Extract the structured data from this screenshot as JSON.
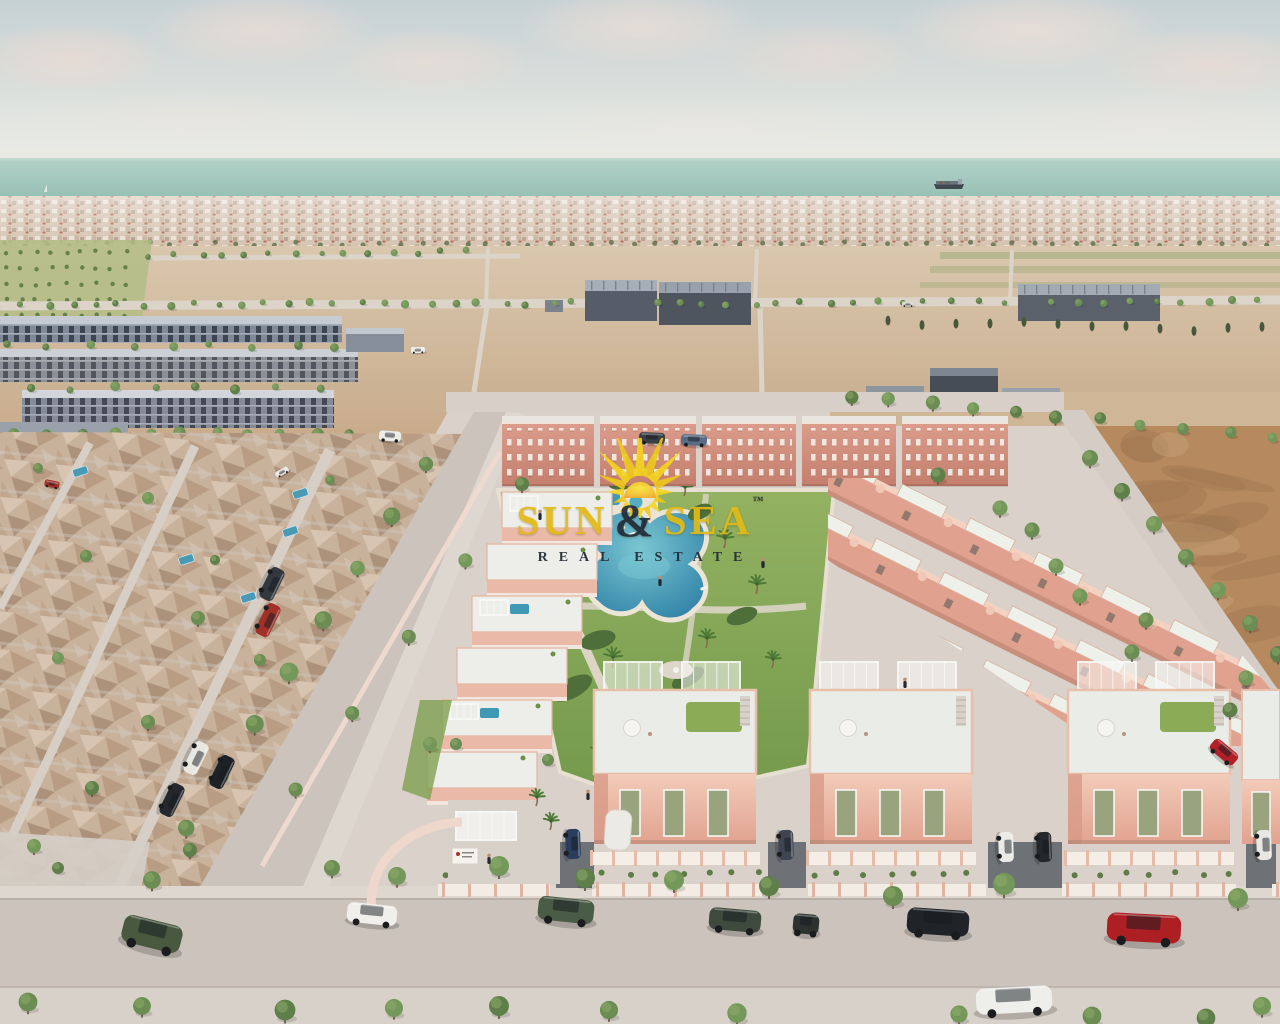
{
  "image": {
    "type": "aerial-3d-architectural-render",
    "subject": "New-build residential development of pink townhouses around a communal lagoon pool, beside an existing neighborhood, vacant plots and the sea on the horizon"
  },
  "watermark": {
    "word1": "SUN",
    "ampersand": "&",
    "word2": "SEA",
    "trademark": "™",
    "subtitle": "REAL ESTATE",
    "colors": {
      "gold": "#E2BA16",
      "dark": "#232B36",
      "sun_yellow": "#F5D51D",
      "sun_orange": "#F0A22E"
    }
  },
  "palette": {
    "sky_top": "#C6D1D4",
    "sky_horizon": "#ECECE6",
    "sea": "#9FC6BC",
    "sand": "#D3BFA6",
    "dirt": "#B68A5E",
    "road": "#DCD4C9",
    "street": "#CCC4BC",
    "sidewalk": "#DED7CF",
    "villa_pink": "#E8B7A5",
    "villa_pink_dark": "#D4917F",
    "apartment_pink": "#C98170",
    "roof_white": "#EAECE7",
    "lawn": "#85A854",
    "pool": "#3A8FAE",
    "tree": "#67874E",
    "tree_dark": "#47583A",
    "gray_buildings": "#5E6675",
    "mesh_tan": "#C9B29C",
    "window_sage": "#99A37D"
  }
}
